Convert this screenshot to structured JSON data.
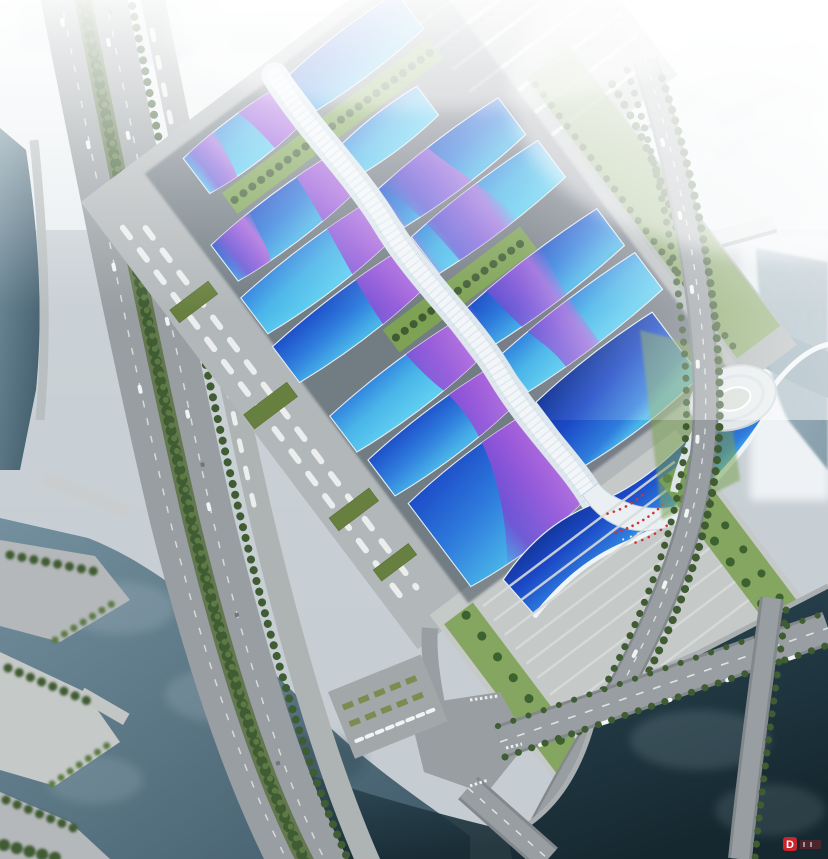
{
  "meta": {
    "title": "Aerial rendering of a riverside exhibition center complex",
    "description": "Bird's-eye architectural rendering: rows of wavy blue-and-purple exhibition hall roofs along a white serpentine central corridor, a south entrance canopy and plaza with palm trees and visitors, flanked by highways, parking lots, rivers with bridges, a spiral terraced landmark building, and a hazy white city skyline."
  },
  "scene": {
    "halls_visible": 13,
    "has_grand_hall": true,
    "has_entrance_canopy": true,
    "landmarks": [
      "central-pedestrian-spine",
      "south-entrance-canopy",
      "entrance-plaza",
      "spiral-terraced-building",
      "river-bridges",
      "west-highway",
      "southeast-pond"
    ]
  },
  "watermark": {
    "badge_letter": "D"
  },
  "palette": {
    "sky_top": "#f2f5f6",
    "sky_mid": "#e2e8ec",
    "sky_low": "#c9d2d7",
    "haze": "#eef2f4",
    "city_block": "#e4eaed",
    "city_shadow": "#bcc6cc",
    "water_light": "#9db1bc",
    "water_mid": "#74909e",
    "water_dark": "#3f5968",
    "pond_top": "#2e4a57",
    "pond_deep": "#152830",
    "road": "#989ea1",
    "road_dark": "#82888c",
    "concrete": "#b4b8ba",
    "plaza": "#c5c9c8",
    "step_line": "#d7dad9",
    "lane_white": "#eceeee",
    "car_white": "#f2f4f4",
    "roof_deep": "#1b49c6",
    "roof_blue": "#2f7ddd",
    "roof_cyan": "#49b4e8",
    "roof_pale": "#5ecdf0",
    "roof_navy": "#10308f",
    "purple_deep": "#7a47d2",
    "purple": "#a055da",
    "magenta": "#c467dc",
    "spine_white": "#e6edf2",
    "spine_shade": "#c3d1da",
    "shadow_navy": "#1d2733",
    "fascia": "#eff4f7",
    "green_dark": "#3f5c33",
    "green_mid": "#5d7a44",
    "green_light": "#87a058",
    "lawn": "#7da254",
    "roof_green": "#68803f",
    "palm": "#3c6230",
    "crowd_red": "#cc3636",
    "watermark_red": "#c9252c"
  }
}
